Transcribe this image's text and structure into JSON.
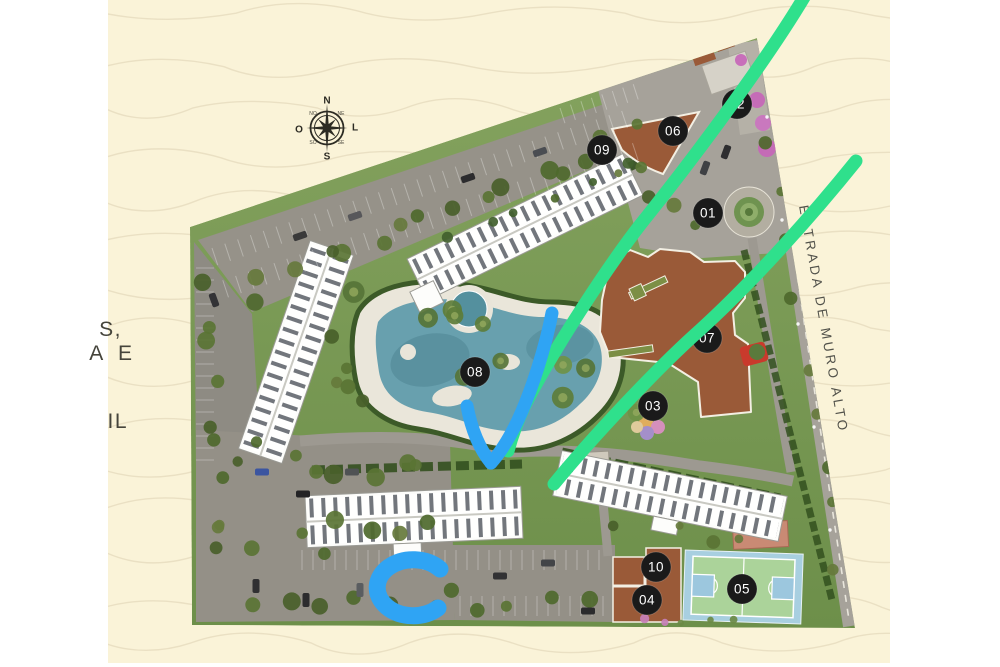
{
  "colors": {
    "canvas_cream": "#faf3d8",
    "wave_line": "#e4dabc",
    "annotation_green": "#2fe08c",
    "annotation_blue": "#2fa4f4",
    "marker_bg": "#1a1a1a",
    "marker_text": "#ffffff"
  },
  "compass": {
    "n": "N",
    "e": "L",
    "s": "S",
    "w": "O",
    "ne": "NE",
    "nw": "NO",
    "se": "SE",
    "sw": "SO"
  },
  "road_label": "ESTRADA DE MURO ALTO",
  "fragments": [
    "S,",
    "A E",
    "IL"
  ],
  "markers": [
    "01",
    "02",
    "03",
    "04",
    "05",
    "06",
    "07",
    "08",
    "09",
    "10"
  ]
}
